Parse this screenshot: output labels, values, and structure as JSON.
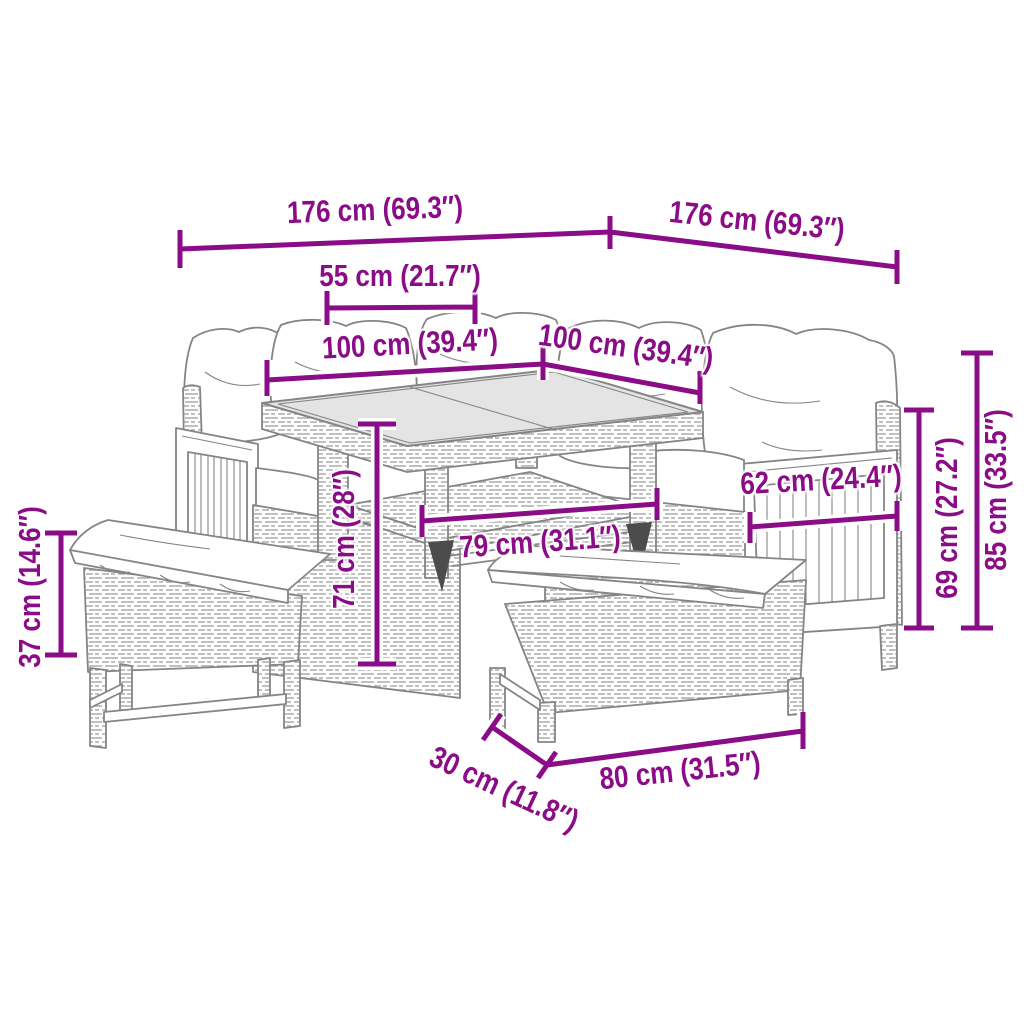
{
  "figure": {
    "type": "product-dimension-diagram",
    "subject": "rattan garden corner sofa set with glass-top table and two cushioned benches",
    "accent_color": "#8A0C86",
    "line_color": "#858585",
    "glass_color": "#e4e4e4",
    "background_color": "#ffffff",
    "unit_primary": "cm",
    "unit_secondary": "inches",
    "dimensions": [
      {
        "id": "dim-176-left",
        "label": "176 cm (69.3″)",
        "cm": 176,
        "inches": 69.3
      },
      {
        "id": "dim-176-right",
        "label": "176 cm (69.3″)",
        "cm": 176,
        "inches": 69.3
      },
      {
        "id": "dim-55",
        "label": "55 cm (21.7″)",
        "cm": 55,
        "inches": 21.7
      },
      {
        "id": "dim-100-left",
        "label": "100 cm (39.4″)",
        "cm": 100,
        "inches": 39.4
      },
      {
        "id": "dim-100-right",
        "label": "100 cm (39.4″)",
        "cm": 100,
        "inches": 39.4
      },
      {
        "id": "dim-62",
        "label": "62 cm (24.4″)",
        "cm": 62,
        "inches": 24.4
      },
      {
        "id": "dim-71",
        "label": "71 cm (28″)",
        "cm": 71,
        "inches": 28
      },
      {
        "id": "dim-79",
        "label": "79 cm (31.1″)",
        "cm": 79,
        "inches": 31.1
      },
      {
        "id": "dim-69",
        "label": "69 cm (27.2″)",
        "cm": 69,
        "inches": 27.2
      },
      {
        "id": "dim-85",
        "label": "85 cm (33.5″)",
        "cm": 85,
        "inches": 33.5
      },
      {
        "id": "dim-37",
        "label": "37 cm (14.6″)",
        "cm": 37,
        "inches": 14.6
      },
      {
        "id": "dim-30",
        "label": "30 cm (11.8″)",
        "cm": 30,
        "inches": 11.8
      },
      {
        "id": "dim-80",
        "label": "80 cm (31.5″)",
        "cm": 80,
        "inches": 31.5
      }
    ],
    "illustration": {
      "items": [
        "corner-sofa",
        "back-pillows",
        "seat-cushions",
        "left-armrest-slat-panel",
        "right-armrest-slat-panel",
        "glass-top-table",
        "table-lower-shelf",
        "bench-left",
        "bench-front"
      ]
    }
  }
}
